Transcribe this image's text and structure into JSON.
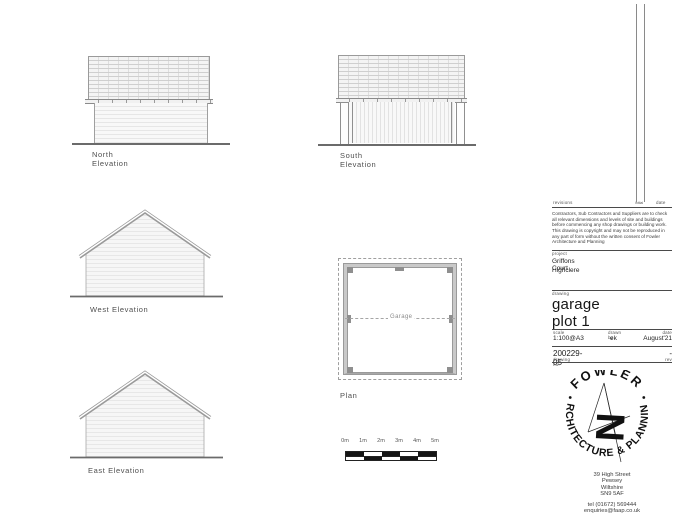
{
  "elevations": {
    "north": {
      "label": "North Elevation"
    },
    "south": {
      "label": "South Elevation"
    },
    "west": {
      "label": "West Elevation"
    },
    "east": {
      "label": "East Elevation"
    }
  },
  "plan": {
    "label": "Plan",
    "room_label": "Garage"
  },
  "scale_bar": {
    "labels": [
      "0m",
      "1m",
      "2m",
      "3m",
      "4m",
      "5m"
    ]
  },
  "title_block": {
    "revisions_label": "revisions",
    "initial_label": "initial",
    "date_col_label": "date",
    "disclaimer_1": "Contractors, Sub Contractors and Suppliers are to check all relevant dimensions and levels of site and buildings before commencing any shop drawings or building work.",
    "disclaimer_2": "This drawing is copyright and may not be reproduced in any part of form without the written consent of Fowler Architecture and Planning",
    "project_label": "project",
    "project_line1": "Griffons Court",
    "project_line2": "Highclere",
    "drawing_label": "drawing",
    "drawing_title": "garage plot 1",
    "scale_label": "scale",
    "scale_value": "1:100@A3",
    "drawn_by_label": "drawn by",
    "drawn_by_value": "ek",
    "date_label": "date",
    "date_value": "August'21",
    "drawing_no_label": "drawing no.",
    "drawing_no_value": "200229-05",
    "rev_label": "rev",
    "rev_value": "-",
    "logo_name": "FOWLER",
    "logo_tagline": "ARCHITECTURE & PLANNING",
    "address_line1": "39 High Street",
    "address_line2": "Pewsey",
    "address_line3": "Wiltshire",
    "address_line4": "SN9 5AF",
    "tel": "tel (01672) 569444",
    "email": "enquiries@faap.co.uk"
  }
}
